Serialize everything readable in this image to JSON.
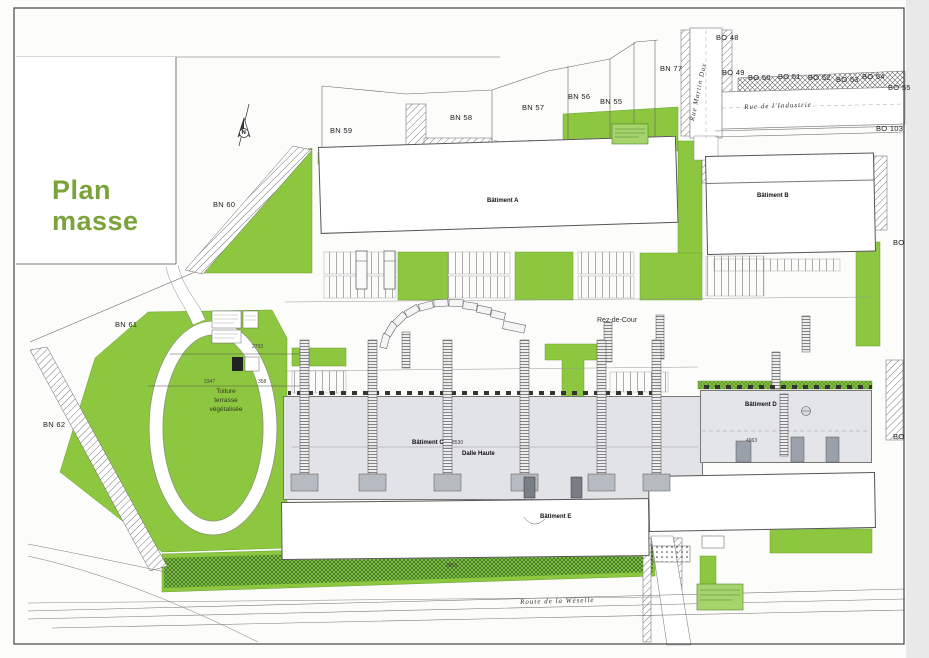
{
  "title": "Plan masse",
  "north_letter": "N",
  "colors": {
    "site_green": "#8dc63f",
    "tree_green": "#3f8a33",
    "title_green": "#7aa33a",
    "slab_gray": "#e2e3e7"
  },
  "parcel_labels": [
    {
      "text": "BN 77",
      "x": 660,
      "y": 64
    },
    {
      "text": "BO 48",
      "x": 716,
      "y": 33
    },
    {
      "text": "BO 49",
      "x": 722,
      "y": 68
    },
    {
      "text": "BO 50",
      "x": 748,
      "y": 73
    },
    {
      "text": "BO 51",
      "x": 778,
      "y": 72
    },
    {
      "text": "BO 52",
      "x": 808,
      "y": 73
    },
    {
      "text": "BO 53",
      "x": 836,
      "y": 75
    },
    {
      "text": "BO 54",
      "x": 862,
      "y": 72
    },
    {
      "text": "BO 55",
      "x": 888,
      "y": 83
    },
    {
      "text": "BO 103",
      "x": 876,
      "y": 124
    },
    {
      "text": "BO",
      "x": 893,
      "y": 238
    },
    {
      "text": "BO",
      "x": 893,
      "y": 432
    },
    {
      "text": "BN 59",
      "x": 330,
      "y": 126
    },
    {
      "text": "BN 58",
      "x": 450,
      "y": 113
    },
    {
      "text": "BN 57",
      "x": 522,
      "y": 103
    },
    {
      "text": "BN 56",
      "x": 568,
      "y": 92
    },
    {
      "text": "BN 55",
      "x": 600,
      "y": 97
    },
    {
      "text": "BN 60",
      "x": 213,
      "y": 200
    },
    {
      "text": "BN 61",
      "x": 115,
      "y": 320
    },
    {
      "text": "BN 62",
      "x": 43,
      "y": 420
    }
  ],
  "street_labels": [
    {
      "text": "Rue de l'Industrie",
      "x": 744,
      "y": 103,
      "rot": -2
    },
    {
      "text": "Rue Martin Dux",
      "x": 688,
      "y": 120,
      "rot": -78
    },
    {
      "text": "Route de la Wéselle",
      "x": 520,
      "y": 598,
      "rot": -1.5
    }
  ],
  "annotations": [
    {
      "text": "Rez-de-Cour",
      "x": 597,
      "y": 317,
      "cls": "lbl-note"
    },
    {
      "text": "Toiture\nterrasse\nvégétalisée",
      "x": 194,
      "y": 388,
      "cls": "lbl-toiture"
    }
  ],
  "dims": [
    {
      "text": "2793",
      "x": 252,
      "y": 344
    },
    {
      "text": "2347",
      "x": 204,
      "y": 379
    },
    {
      "text": "358",
      "x": 258,
      "y": 379
    },
    {
      "text": "8530",
      "x": 452,
      "y": 440
    },
    {
      "text": "4063",
      "x": 746,
      "y": 438
    },
    {
      "text": "9855",
      "x": 446,
      "y": 563
    }
  ],
  "buildings": {
    "a": {
      "label": "Bâtiment A",
      "lots": [
        {
          "name": "Lot A.1",
          "dim": "1493"
        },
        {
          "name": "Lot A.2",
          "dim": "1500"
        },
        {
          "name": "Lot A.3",
          "dim": "1500"
        },
        {
          "name": "Lot A.4",
          "dim": "1499"
        },
        {
          "name": "Lot A.5",
          "dim": "1500"
        },
        {
          "name": "Lot A.6",
          "dim": "2336"
        }
      ]
    },
    "b": {
      "label": "Bâtiment B",
      "lots": [
        {
          "name": "Lot B-1",
          "dim": "1500"
        },
        {
          "name": "Lot B-2",
          "dim": "1500"
        },
        {
          "name": "Lot B-3",
          "dim": "1535"
        }
      ]
    },
    "c": {
      "label": "Bâtiment C",
      "sublabel": "Dalle Haute"
    },
    "d": {
      "label": "Bâtiment D"
    },
    "e": {
      "label": "Bâtiment E",
      "lots": [
        {
          "name": "Lot E.1",
          "dim": "800"
        },
        {
          "name": "Lot E.2",
          "dim": "780"
        },
        {
          "name": "Lot E.3",
          "dim": "780"
        },
        {
          "name": "Lot E.4",
          "dim": "780"
        },
        {
          "name": "Lot E.5",
          "dim": "780"
        },
        {
          "name": "Lot E.6",
          "dim": "780"
        },
        {
          "name": "Lot E.7",
          "dim": "780"
        },
        {
          "name": "Lot E.8",
          "dim": "780"
        },
        {
          "name": "Lot E.9",
          "dim": "780"
        },
        {
          "name": "Lot E.10",
          "dim": "780"
        },
        {
          "name": "Lot E.11",
          "dim": "780"
        },
        {
          "name": "Lot E.12",
          "dim": "780"
        },
        {
          "name": "Lot E.13",
          "dim": "780"
        }
      ]
    },
    "e2": {
      "lots": [
        {
          "name": "Lot E.14",
          "dim": "1440"
        },
        {
          "name": "Lot E.15",
          "dim": "1125"
        },
        {
          "name": "Lot E.16",
          "dim": "1103"
        },
        {
          "name": "Lot E.17",
          "dim": "1103"
        },
        {
          "name": "Lot E.18",
          "dim": "1125"
        }
      ]
    }
  }
}
